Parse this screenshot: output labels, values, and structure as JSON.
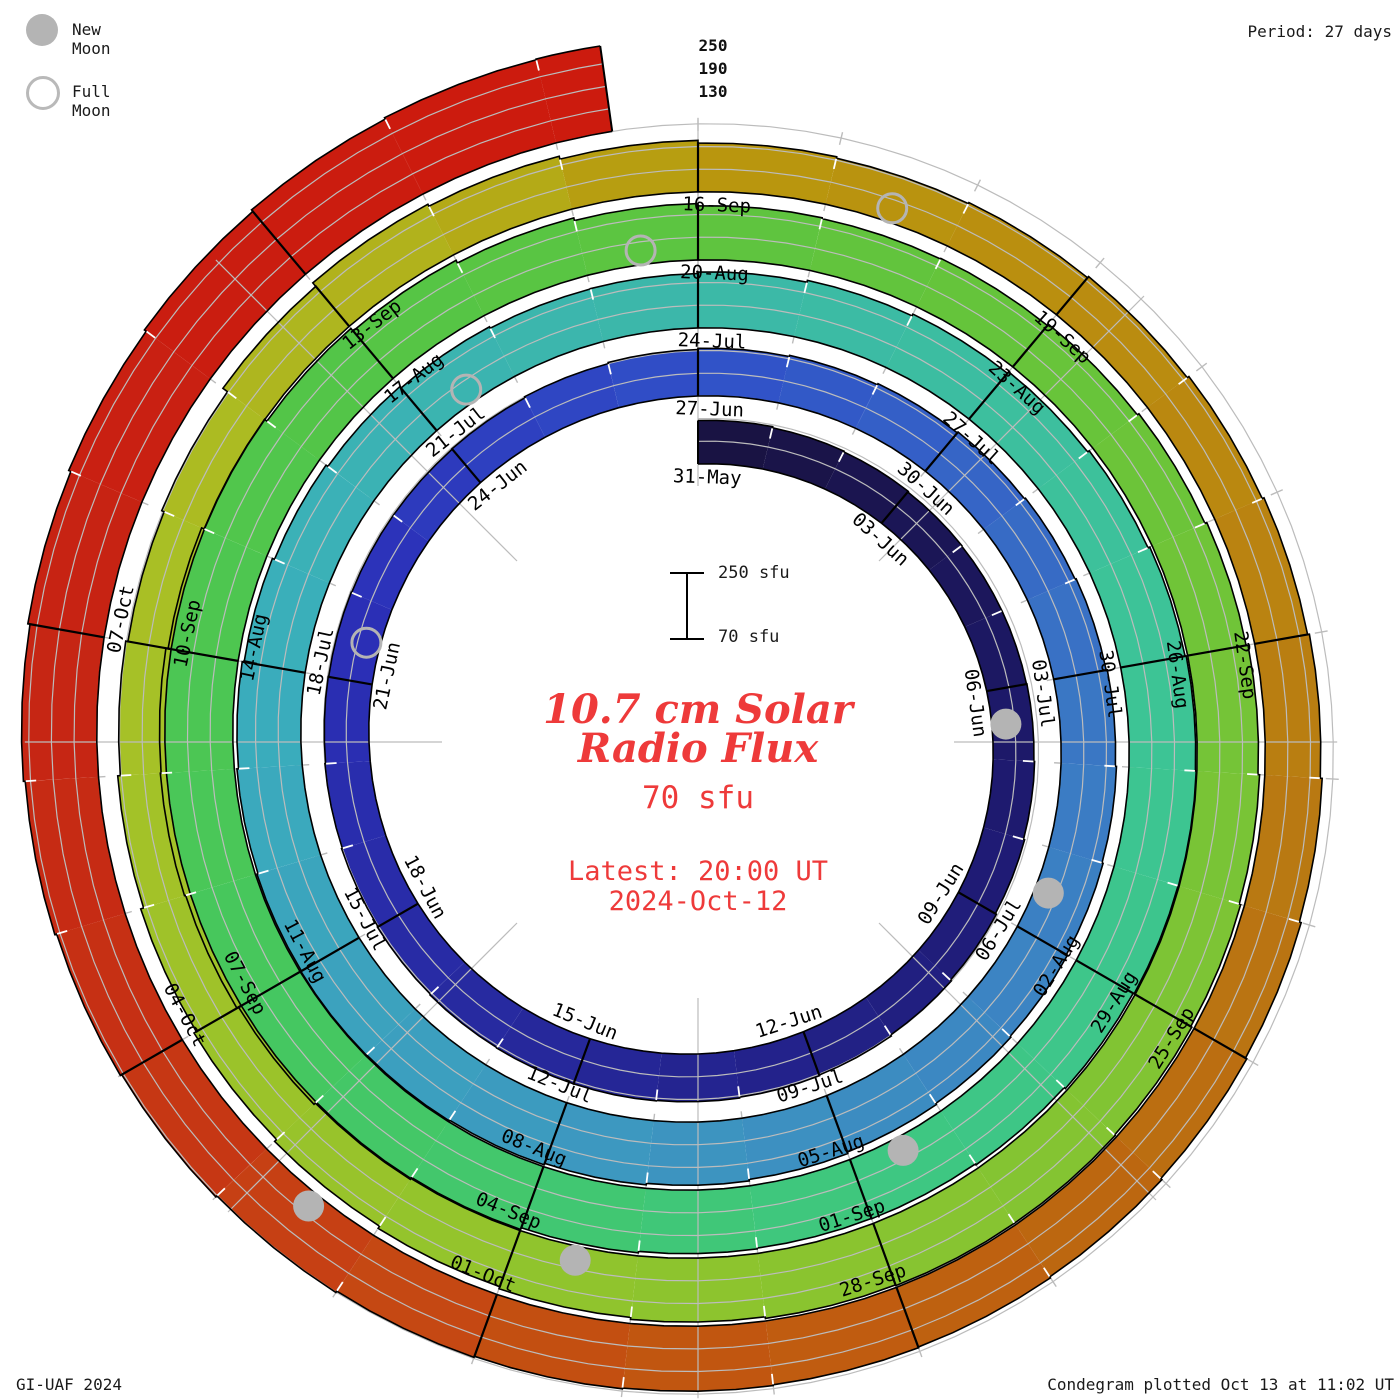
{
  "legend": {
    "new_moon": "New Moon",
    "full_moon": "Full Moon"
  },
  "header": {
    "period": "Period: 27 days"
  },
  "footer": {
    "left": "GI-UAF 2024",
    "right": "Condegram plotted Oct 13 at 11:02 UT"
  },
  "center": {
    "title_line1": "10.7 cm Solar",
    "title_line2": "Radio Flux",
    "current_flux": "70 sfu",
    "latest_label": "Latest: 20:00 UT",
    "latest_date": "2024-Oct-12",
    "scale_top": "250 sfu",
    "scale_bottom": "70 sfu"
  },
  "radial_axis": {
    "labels": [
      "250",
      "190",
      "130"
    ]
  },
  "chart_data": {
    "type": "area",
    "subtype": "condegram-solar-spiral",
    "title": "10.7 cm Solar Radio Flux",
    "period_days": 27,
    "start_date": "2024-05-31",
    "end_date": "2024-10-12",
    "latest": "2024-Oct-12 20:00 UT",
    "flux_base_sfu": 70,
    "flux_gridlines_sfu": [
      130,
      190,
      250
    ],
    "daily_flux_sfu": [
      185,
      182,
      180,
      178,
      177,
      177,
      178,
      180,
      183,
      186,
      189,
      192,
      194,
      196,
      197,
      197,
      196,
      194,
      192,
      190,
      188,
      187,
      186,
      186,
      187,
      190,
      193,
      196,
      199,
      202,
      205,
      208,
      211,
      214,
      217,
      220,
      223,
      226,
      229,
      233,
      237,
      241,
      245,
      247,
      248,
      246,
      243,
      239,
      234,
      228,
      222,
      217,
      213,
      214,
      218,
      223,
      228,
      233,
      238,
      243,
      246,
      248,
      247,
      244,
      240,
      237,
      236,
      238,
      242,
      247,
      253,
      258,
      263,
      266,
      264,
      258,
      251,
      243,
      234,
      226,
      219,
      213,
      211,
      213,
      217,
      222,
      227,
      232,
      236,
      240,
      243,
      245,
      245,
      243,
      239,
      234,
      228,
      221,
      214,
      207,
      199,
      192,
      186,
      193,
      208,
      220,
      214,
      206,
      199,
      195,
      198,
      202,
      207,
      212,
      217,
      222,
      227,
      231,
      235,
      238,
      240,
      242,
      244,
      247,
      251,
      255,
      259,
      264,
      269,
      275,
      281,
      287,
      292,
      296,
      298
    ],
    "date_labels": [
      {
        "d": 0,
        "t": "31-May"
      },
      {
        "d": 3,
        "t": "03-Jun"
      },
      {
        "d": 6,
        "t": "06-Jun"
      },
      {
        "d": 9,
        "t": "09-Jun"
      },
      {
        "d": 12,
        "t": "12-Jun"
      },
      {
        "d": 15,
        "t": "15-Jun"
      },
      {
        "d": 18,
        "t": "18-Jun"
      },
      {
        "d": 21,
        "t": "21-Jun"
      },
      {
        "d": 24,
        "t": "24-Jun"
      },
      {
        "d": 27,
        "t": "27-Jun"
      },
      {
        "d": 30,
        "t": "30-Jun"
      },
      {
        "d": 33,
        "t": "03-Jul"
      },
      {
        "d": 36,
        "t": "06-Jul"
      },
      {
        "d": 39,
        "t": "09-Jul"
      },
      {
        "d": 42,
        "t": "12-Jul"
      },
      {
        "d": 45,
        "t": "15-Jul"
      },
      {
        "d": 48,
        "t": "18-Jul"
      },
      {
        "d": 51,
        "t": "21-Jul"
      },
      {
        "d": 54,
        "t": "24-Jul"
      },
      {
        "d": 57,
        "t": "27-Jul"
      },
      {
        "d": 60,
        "t": "30-Jul"
      },
      {
        "d": 63,
        "t": "02-Aug"
      },
      {
        "d": 66,
        "t": "05-Aug"
      },
      {
        "d": 69,
        "t": "08-Aug"
      },
      {
        "d": 72,
        "t": "11-Aug"
      },
      {
        "d": 75,
        "t": "14-Aug"
      },
      {
        "d": 78,
        "t": "17-Aug"
      },
      {
        "d": 81,
        "t": "20-Aug"
      },
      {
        "d": 84,
        "t": "23-Aug"
      },
      {
        "d": 87,
        "t": "26-Aug"
      },
      {
        "d": 90,
        "t": "29-Aug"
      },
      {
        "d": 93,
        "t": "01-Sep"
      },
      {
        "d": 96,
        "t": "04-Sep"
      },
      {
        "d": 99,
        "t": "07-Sep"
      },
      {
        "d": 102,
        "t": "10-Sep"
      },
      {
        "d": 105,
        "t": "13-Sep"
      },
      {
        "d": 108,
        "t": "16-Sep"
      },
      {
        "d": 111,
        "t": "19-Sep"
      },
      {
        "d": 114,
        "t": "22-Sep"
      },
      {
        "d": 117,
        "t": "25-Sep"
      },
      {
        "d": 120,
        "t": "28-Sep"
      },
      {
        "d": 123,
        "t": "01-Oct"
      },
      {
        "d": 126,
        "t": "04-Oct"
      },
      {
        "d": 129,
        "t": "07-Oct"
      }
    ],
    "moons": {
      "new": [
        {
          "d": 6,
          "date": "2024-06-06"
        },
        {
          "d": 35,
          "date": "2024-07-05"
        },
        {
          "d": 65,
          "date": "2024-08-04"
        },
        {
          "d": 95,
          "date": "2024-09-03"
        },
        {
          "d": 124,
          "date": "2024-10-02"
        }
      ],
      "full": [
        {
          "d": 21,
          "date": "2024-06-21"
        },
        {
          "d": 51,
          "date": "2024-07-21"
        },
        {
          "d": 80,
          "date": "2024-08-19"
        },
        {
          "d": 109,
          "date": "2024-09-17"
        }
      ]
    },
    "color_stops": [
      [
        0,
        "#191240"
      ],
      [
        8,
        "#1e1a72"
      ],
      [
        16,
        "#27299e"
      ],
      [
        22,
        "#2b30b8"
      ],
      [
        27,
        "#3050c8"
      ],
      [
        34,
        "#3b7ac4"
      ],
      [
        41,
        "#3d96c0"
      ],
      [
        48,
        "#3aaebc"
      ],
      [
        54,
        "#3cb8a8"
      ],
      [
        60,
        "#3dc497"
      ],
      [
        66,
        "#3ec780"
      ],
      [
        72,
        "#46c75e"
      ],
      [
        78,
        "#54c546"
      ],
      [
        84,
        "#66c43a"
      ],
      [
        90,
        "#7fc434"
      ],
      [
        96,
        "#92c42c"
      ],
      [
        102,
        "#a8c126"
      ],
      [
        106,
        "#b2b01a"
      ],
      [
        108,
        "#b9980e"
      ],
      [
        112,
        "#ba8a10"
      ],
      [
        116,
        "#b97712"
      ],
      [
        119,
        "#bd6410"
      ],
      [
        122,
        "#c25310"
      ],
      [
        124,
        "#c64414"
      ],
      [
        126,
        "#c63214"
      ],
      [
        129,
        "#c62414"
      ],
      [
        132,
        "#cb1c0f"
      ],
      [
        134,
        "#cc1b0e"
      ]
    ],
    "layout": {
      "cx": 698,
      "cy": 742,
      "r0": 278,
      "px_per_day": 2.52,
      "px_per_sfu": 0.378,
      "d_start": 0,
      "d_end": 134.4,
      "spoke_angles_deg": [
        0,
        45,
        90,
        135,
        180,
        225,
        270,
        315
      ],
      "grid_on": true,
      "legend_position": "top-left"
    },
    "colors": {
      "accent_red": "#ee3a3a",
      "grid": "#bcbcbc",
      "moon_gray": "#b4b4b4",
      "outline": "#000000"
    }
  }
}
